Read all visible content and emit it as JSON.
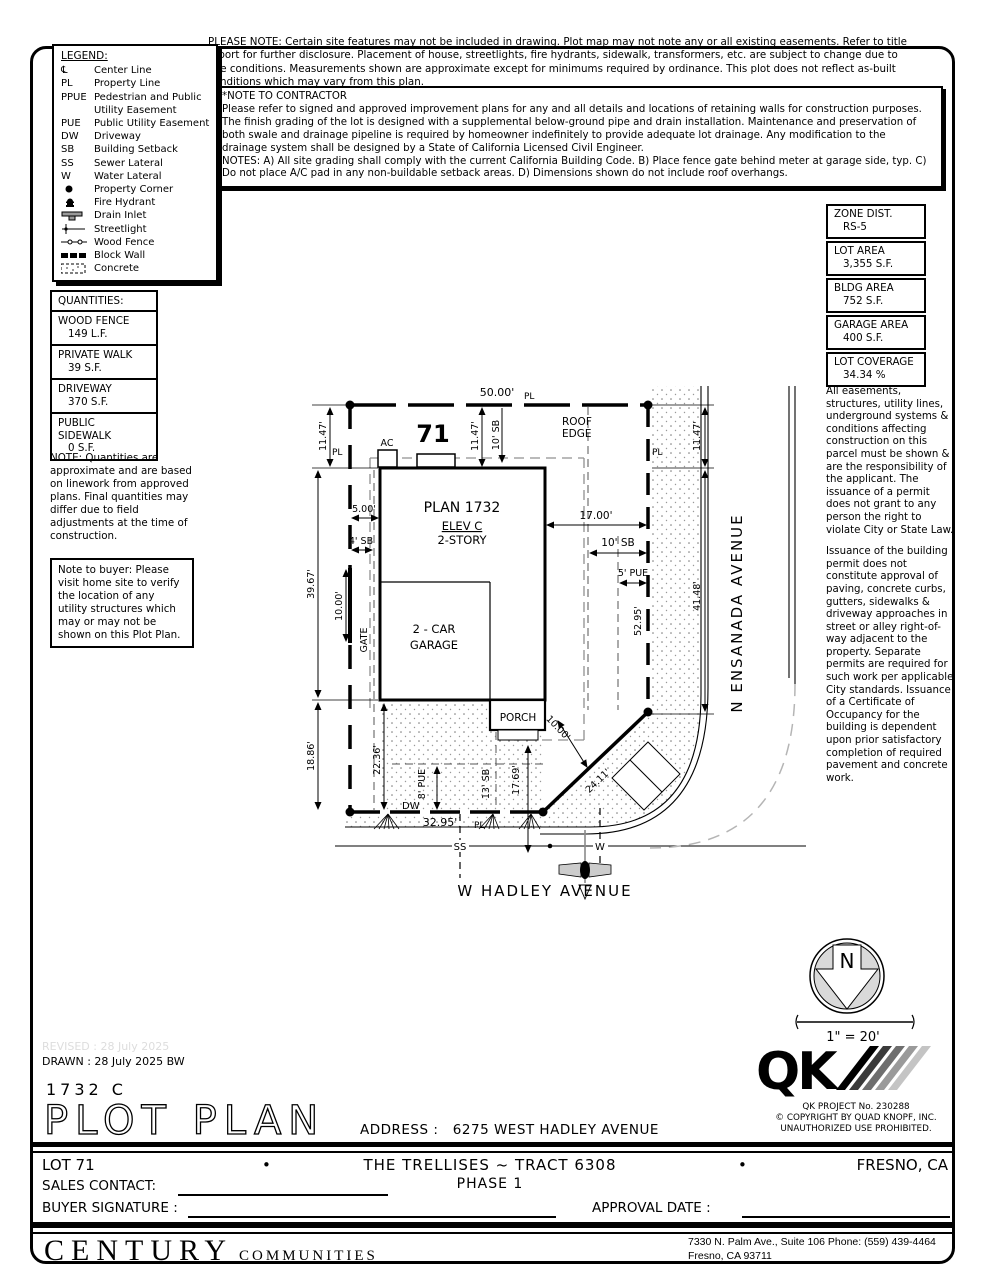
{
  "notes": {
    "please_note": "PLEASE NOTE:  Certain site features may not be included in drawing.  Plot map may not note any or all existing easements. Refer to title report for further disclosure.  Placement of house, streetlights, fire hydrants, sidewalk, transformers, etc. are subject to change due to site conditions.  Measurements shown are approximate except for minimums required by ordinance.  This plot does not reflect as-built conditions which may vary from this plan.",
    "contractor_title": "*NOTE TO CONTRACTOR",
    "contractor_p1": "Please refer to signed and approved improvement plans for any and all details and locations of retaining walls for construction purposes.",
    "contractor_p2": "The finish grading of the lot is designed with a supplemental below-ground pipe and drain installation.  Maintenance and preservation of both swale and drainage pipeline is required by homeowner indefinitely to provide adequate lot drainage.  Any modification to the drainage system shall be designed by a State of California Licensed Civil Engineer.",
    "contractor_p3": "NOTES:  A) All site grading shall comply with the current California Building Code.  B) Place fence gate behind meter at garage side, typ.  C) Do not place A/C pad in any non-buildable setback areas.  D) Dimensions shown do not include roof overhangs.",
    "quantities_note": "NOTE: Quantities are approximate and are based on linework from approved plans.  Final quantities may differ due to field adjustments at the time of construction.",
    "buyer_note": "Note to buyer: Please visit home site to verify the location of any utility structures which may or may not be shown on this Plot Plan.",
    "right_note_1": "All easements, structures, utility lines, underground systems & conditions affecting construction on this parcel must be shown & are the responsibility of the applicant. The issuance of a permit does not grant to any person the right to violate City or State Law.",
    "right_note_2": "Issuance of the building permit does not constitute approval of paving, concrete curbs, gutters, sidewalks & driveway approaches in street or alley right-of-way adjacent to the property. Separate permits are required for such work per applicable City standards. Issuance of a Certificate of Occupancy for the building is dependent upon prior satisfactory completion of required pavement and concrete work."
  },
  "legend": {
    "title": "LEGEND:",
    "items": [
      {
        "abbr": "℄",
        "label": "Center Line"
      },
      {
        "abbr": "PL",
        "label": "Property Line"
      },
      {
        "abbr": "PPUE",
        "label": "Pedestrian and Public Utility Easement"
      },
      {
        "abbr": "PUE",
        "label": "Public Utility Easement"
      },
      {
        "abbr": "DW",
        "label": "Driveway"
      },
      {
        "abbr": "SB",
        "label": "Building Setback"
      },
      {
        "abbr": "SS",
        "label": "Sewer Lateral"
      },
      {
        "abbr": "W",
        "label": "Water Lateral"
      },
      {
        "abbr": "",
        "label": "Property Corner"
      },
      {
        "abbr": "",
        "label": "Fire Hydrant"
      },
      {
        "abbr": "",
        "label": "Drain Inlet"
      },
      {
        "abbr": "",
        "label": "Streetlight"
      },
      {
        "abbr": "",
        "label": "Wood Fence"
      },
      {
        "abbr": "",
        "label": "Block Wall"
      },
      {
        "abbr": "",
        "label": "Concrete"
      }
    ]
  },
  "zone_table": {
    "rows": [
      {
        "label": "ZONE DIST.",
        "value": "RS-5"
      },
      {
        "label": "LOT AREA",
        "value": "3,355 S.F."
      },
      {
        "label": "BLDG AREA",
        "value": "752 S.F."
      },
      {
        "label": "GARAGE AREA",
        "value": "400 S.F."
      },
      {
        "label": "LOT COVERAGE",
        "value": "34.34 %"
      }
    ]
  },
  "quantities": {
    "title": "QUANTITIES:",
    "rows": [
      {
        "label": "WOOD FENCE",
        "value": "149 L.F."
      },
      {
        "label": "PRIVATE WALK",
        "value": "39 S.F."
      },
      {
        "label": "DRIVEWAY",
        "value": "370 S.F."
      },
      {
        "label": "PUBLIC SIDEWALK",
        "value": "0 S.F."
      }
    ]
  },
  "plot": {
    "dim_50_00": "50.00'",
    "pl": "PL",
    "lot_number": "71",
    "ac": "AC",
    "dim_11_47_left": "11.47'",
    "dim_11_47_top": "11.47'",
    "dim_11_47_right": "11.47'",
    "sb_10_top": "10' SB",
    "sb_10_right": "10' SB",
    "roof_edge_1": "ROOF",
    "roof_edge_2": "EDGE",
    "plan_name": "PLAN 1732",
    "elev": "ELEV C",
    "story": "2-STORY",
    "dim_5_00": "5.00'",
    "sb_4": "4' SB",
    "dim_17_00": "17.00'",
    "pue_5": "5' PUE",
    "dim_39_67": "39.67'",
    "dim_10_00_gate": "10.00'",
    "gate": "GATE",
    "dim_18_86": "18.86'",
    "garage_1": "2 - CAR",
    "garage_2": "GARAGE",
    "porch": "PORCH",
    "dim_52_95": "52.95'",
    "dim_41_48": "41.48'",
    "dim_22_36": "22.36'",
    "pue_8": "8' PUE",
    "sb_13": "13' SB",
    "dim_17_69": "17.69'",
    "dw": "DW",
    "dim_32_95": "32.95'",
    "ss": "SS",
    "w": "W",
    "dim_10_00_diag": "10.00'",
    "dim_24_11": "24.11'",
    "street_right": "N ENSANADA AVENUE",
    "street_bottom": "W HADLEY AVENUE"
  },
  "north": {
    "n": "N",
    "scale": "1\" = 20'"
  },
  "qk": {
    "logo": "QK",
    "project": "QK PROJECT No. 230288",
    "copyright": "©  COPYRIGHT BY QUAD KNOPF, INC.",
    "unauthorized": "UNAUTHORIZED USE PROHIBITED."
  },
  "titleblock": {
    "revised": "REVISED :  28 July 2025",
    "drawn": "DRAWN :  28 July 2025  BW",
    "plan_code": "1732  C",
    "title": "PLOT PLAN",
    "address_label": "ADDRESS :",
    "address": "6275 WEST HADLEY AVENUE",
    "lot": "LOT 71",
    "bullet": "•",
    "tract": "THE TRELLISES ~ TRACT 6308",
    "phase": "PHASE 1",
    "city": "FRESNO, CA",
    "sales_label": "SALES CONTACT:",
    "buyer_label": "BUYER SIGNATURE :",
    "approval_label": "APPROVAL DATE :"
  },
  "century": {
    "name": "CENTURY",
    "sub": "COMMUNITIES",
    "line1": "7330 N. Palm Ave., Suite 106    Phone:  (559) 439-4464",
    "line2": "Fresno, CA  93711"
  }
}
